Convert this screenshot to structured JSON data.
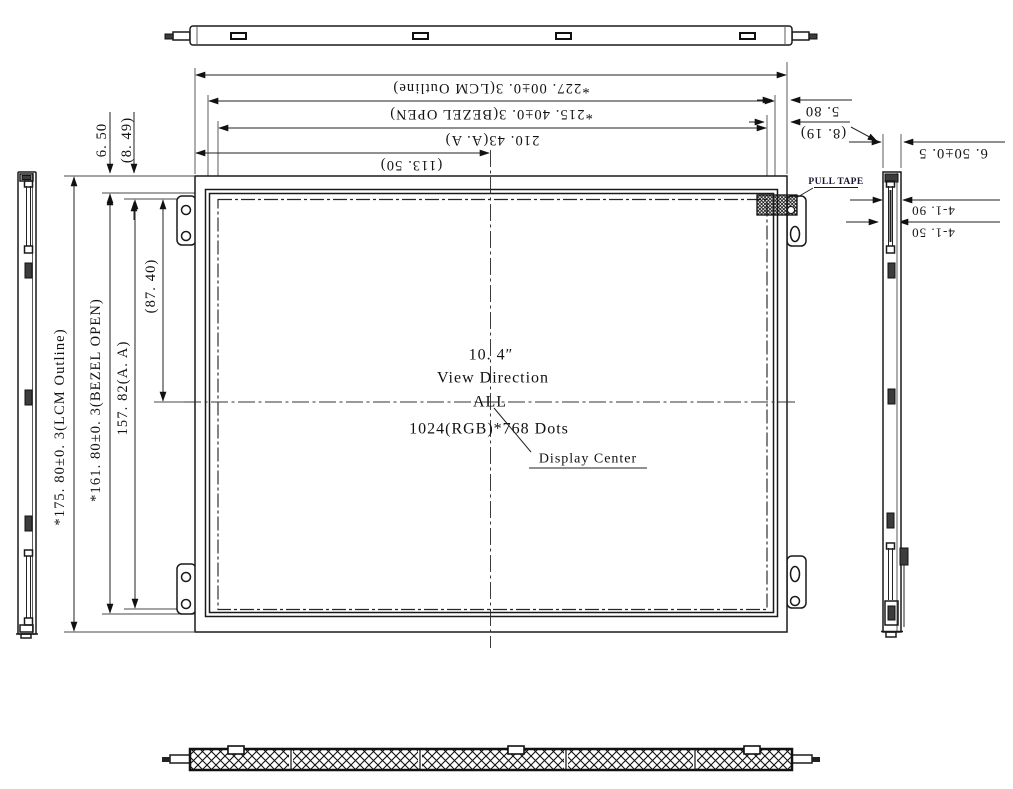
{
  "drawing": {
    "type": "LCD module mechanical outline drawing",
    "colors": {
      "line": "#1a1a1a",
      "dim_line": "#222222",
      "pull_tape_label": "#16162e",
      "background": "#ffffff"
    }
  },
  "dims": {
    "top": {
      "lcm_outline_width": "*227. 00±0. 3(LCM Outline)",
      "bezel_open_width": "*215. 40±0. 3(BEZEL OPEN)",
      "active_area_width": "210. 43(A. A)",
      "center_offset_x": "(113. 50)"
    },
    "left": {
      "bezel_top_offset": "6. 50",
      "active_area_top_offset": "(8. 49)",
      "lcm_outline_height": "*175. 80±0. 3(LCM Outline)",
      "bezel_open_height": "*161. 80±0. 3(BEZEL OPEN)",
      "active_area_height": "157. 82(A. A)",
      "center_offset_y": "(87. 40)"
    },
    "right": {
      "bezel_edge_offset": "5. 80",
      "active_area_edge_offset": "(8. 19)",
      "module_thickness": "6. 50±0. 5",
      "feature_a": "4-1. 90",
      "feature_b": "4-1. 50"
    }
  },
  "center": {
    "size": "10. 4″",
    "view_direction_label": "View Direction",
    "view_direction_value": "ALL",
    "resolution": "1024(RGB)*768 Dots",
    "display_center": "Display Center"
  },
  "labels": {
    "pull_tape": "PULL TAPE"
  }
}
